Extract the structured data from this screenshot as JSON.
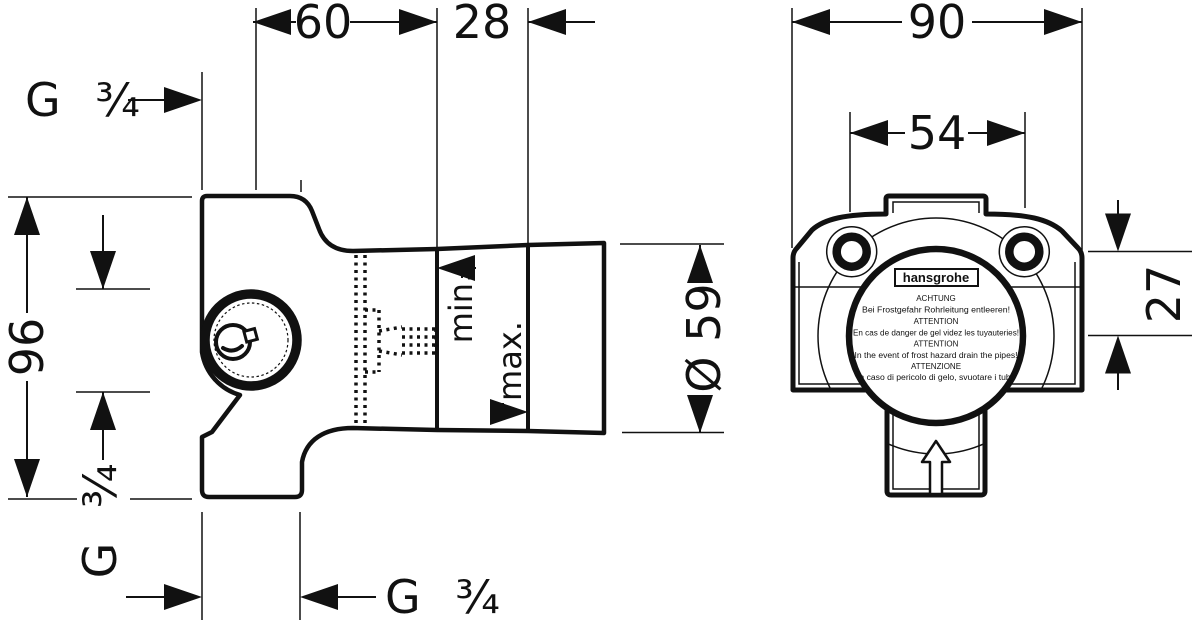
{
  "colors": {
    "ink": "#111111",
    "background": "#ffffff"
  },
  "left_view": {
    "dim_depth_60": "60",
    "dim_depth_28": "28",
    "dim_height_96": "96",
    "dim_cartridge_diameter": "Ø 59",
    "thread_rear": "G ¾",
    "thread_side": "G ¾",
    "thread_bottom": "G ¾",
    "label_min": "min.",
    "label_max": "max."
  },
  "right_view": {
    "dim_width_90": "90",
    "dim_port_spacing_54": "54",
    "dim_axis_offset_27": "27",
    "label": {
      "brand": "hansgrohe",
      "lines": [
        "ACHTUNG",
        "Bei Frostgefahr Rohrleitung entleeren!",
        "ATTENTION",
        "En cas de danger de gel videz les tuyauteries!",
        "ATTENTION",
        "In the event of frost hazard drain the pipes!",
        "ATTENZIONE",
        "In caso di pericolo di gelo, svuotare i tubi!"
      ]
    }
  }
}
